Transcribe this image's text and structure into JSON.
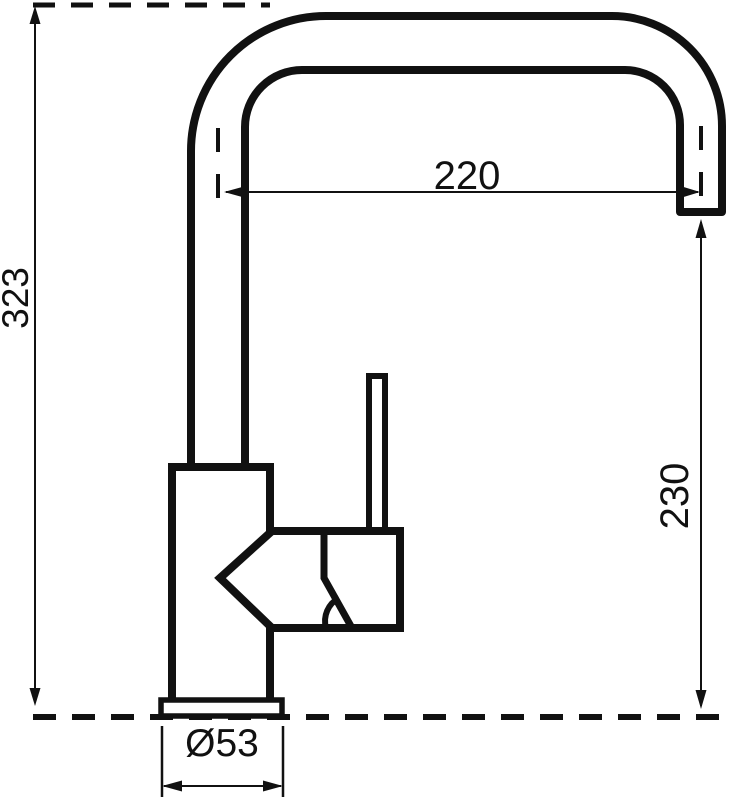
{
  "diagram": {
    "type": "technical-drawing",
    "subject": "single-lever kitchen mixer tap, side view with dimensions",
    "background_color": "#ffffff",
    "line_color": "#111111",
    "dimensions": {
      "overall_height": {
        "label": "323",
        "orientation": "vertical",
        "position": "left"
      },
      "spout_reach": {
        "label": "220",
        "orientation": "horizontal",
        "position": "top"
      },
      "spout_outlet_height": {
        "label": "230",
        "orientation": "vertical",
        "position": "right"
      },
      "base_diameter": {
        "label": "Ø53",
        "orientation": "horizontal",
        "position": "bottom"
      }
    }
  }
}
